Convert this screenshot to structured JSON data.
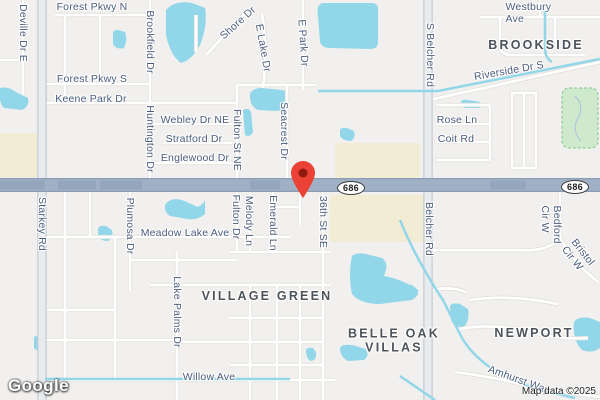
{
  "map": {
    "provider_logo": "Google",
    "attribution": "Map data ©2025",
    "marker": {
      "name": "dropped-pin",
      "tip_x": 303,
      "tip_y": 198
    },
    "route_shields": [
      {
        "label": "686",
        "x": 351,
        "y": 188
      },
      {
        "label": "686",
        "x": 575,
        "y": 187
      }
    ],
    "area_labels": [
      {
        "text": "BROOKSIDE",
        "x": 536,
        "y": 45
      },
      {
        "text": "VILLAGE GREEN",
        "x": 267,
        "y": 296
      },
      {
        "text": "BELLE OAK\nVILLAS",
        "x": 394,
        "y": 341
      },
      {
        "text": "NEWPORT",
        "x": 534,
        "y": 333
      }
    ],
    "street_labels": [
      {
        "text": "Forest Pkwy N",
        "x": 92,
        "y": 7,
        "rot": 0
      },
      {
        "text": "Deville Dr E",
        "x": 23,
        "y": 33,
        "rot": 90
      },
      {
        "text": "Brookfield Dr",
        "x": 150,
        "y": 42,
        "rot": 90
      },
      {
        "text": "Shore Dr",
        "x": 238,
        "y": 23,
        "rot": -42
      },
      {
        "text": "E Lake Dr",
        "x": 263,
        "y": 48,
        "rot": 80
      },
      {
        "text": "E Park Dr",
        "x": 303,
        "y": 43,
        "rot": 86
      },
      {
        "text": "Westbury Ave",
        "x": 537,
        "y": 13,
        "rot": 0
      },
      {
        "text": "S Belcher Rd",
        "x": 430,
        "y": 55,
        "rot": 90
      },
      {
        "text": "Riverside Dr S",
        "x": 509,
        "y": 71,
        "rot": -10
      },
      {
        "text": "Forest Pkwy S",
        "x": 92,
        "y": 79,
        "rot": 0
      },
      {
        "text": "Keene Park Dr",
        "x": 91,
        "y": 99,
        "rot": 0
      },
      {
        "text": "Webley Dr NE",
        "x": 195,
        "y": 120,
        "rot": 0
      },
      {
        "text": "Stratford Dr",
        "x": 194,
        "y": 139,
        "rot": 0
      },
      {
        "text": "Englewood Dr",
        "x": 195,
        "y": 158,
        "rot": 0
      },
      {
        "text": "Huntington Dr",
        "x": 150,
        "y": 139,
        "rot": 90
      },
      {
        "text": "Fulton St NE",
        "x": 237,
        "y": 140,
        "rot": 90
      },
      {
        "text": "Seacrest Dr",
        "x": 284,
        "y": 131,
        "rot": 90
      },
      {
        "text": "Rose Ln",
        "x": 457,
        "y": 120,
        "rot": 0
      },
      {
        "text": "Coit Rd",
        "x": 456,
        "y": 139,
        "rot": 0
      },
      {
        "text": "Starkey Rd",
        "x": 42,
        "y": 224,
        "rot": 90
      },
      {
        "text": "Plumosa Dr",
        "x": 130,
        "y": 226,
        "rot": 90
      },
      {
        "text": "Meadow Lake Ave",
        "x": 185,
        "y": 233,
        "rot": 0
      },
      {
        "text": "Fulton Dr",
        "x": 236,
        "y": 217,
        "rot": 90
      },
      {
        "text": "Melody Ln",
        "x": 249,
        "y": 221,
        "rot": 90
      },
      {
        "text": "Emerald Ln",
        "x": 273,
        "y": 223,
        "rot": 90
      },
      {
        "text": "36th St SE",
        "x": 323,
        "y": 222,
        "rot": 90
      },
      {
        "text": "Belcher Rd",
        "x": 429,
        "y": 229,
        "rot": 90
      },
      {
        "text": "Bedford Cir W",
        "x": 551,
        "y": 230,
        "rot": 90
      },
      {
        "text": "Bristol Cir W",
        "x": 578,
        "y": 256,
        "rot": 52
      },
      {
        "text": "Lake Palms Dr",
        "x": 177,
        "y": 312,
        "rot": 90
      },
      {
        "text": "Willow Ave",
        "x": 209,
        "y": 377,
        "rot": 0
      },
      {
        "text": "Amhurst Way",
        "x": 519,
        "y": 380,
        "rot": 20
      }
    ],
    "colors": {
      "land": "#f1f0ee",
      "water": "#92d7e9",
      "commercial": "#f3ecd5",
      "park": "#cfe9cd",
      "park_border": "#86c488",
      "road_minor_casing": "#e0ddd8",
      "road_minor": "#ffffff",
      "road_secondary_casing": "#c6ccd4",
      "road_secondary": "#e9ecef",
      "highway": "#a0b1c6",
      "highway_edge": "#8b9db5",
      "highway_dark": "#7e94b0",
      "label_street": "#4b5d7e",
      "label_area": "#4d535a",
      "marker_red": "#ea4335",
      "marker_core": "#8f1b0e"
    }
  }
}
